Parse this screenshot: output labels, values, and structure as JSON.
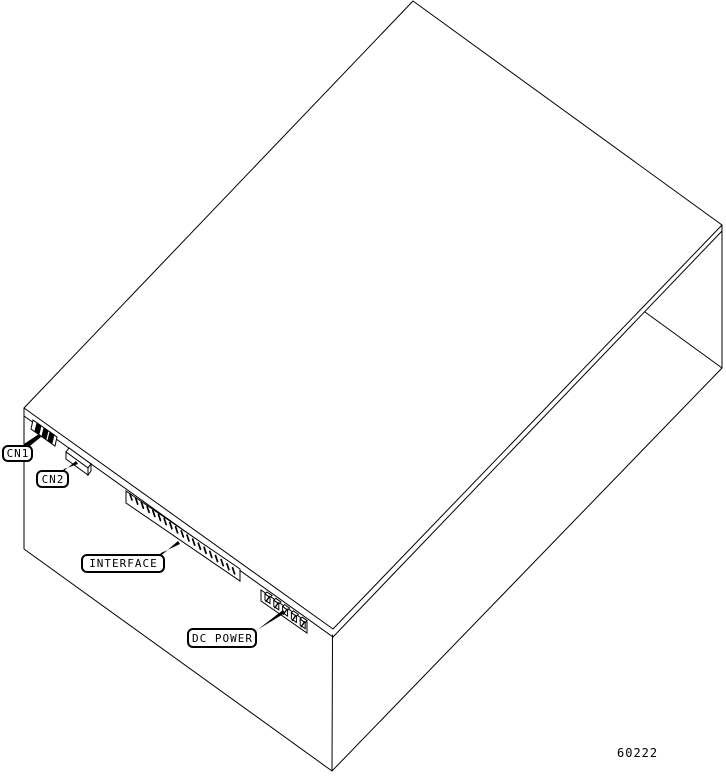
{
  "figure": {
    "number": "60222"
  },
  "callouts": [
    {
      "id": "cn1",
      "label": "CN1"
    },
    {
      "id": "cn2",
      "label": "CN2"
    },
    {
      "id": "interface",
      "label": "INTERFACE"
    },
    {
      "id": "dc-power",
      "label": "DC POWER"
    }
  ],
  "colors": {
    "line": "#000000",
    "background": "#ffffff"
  }
}
